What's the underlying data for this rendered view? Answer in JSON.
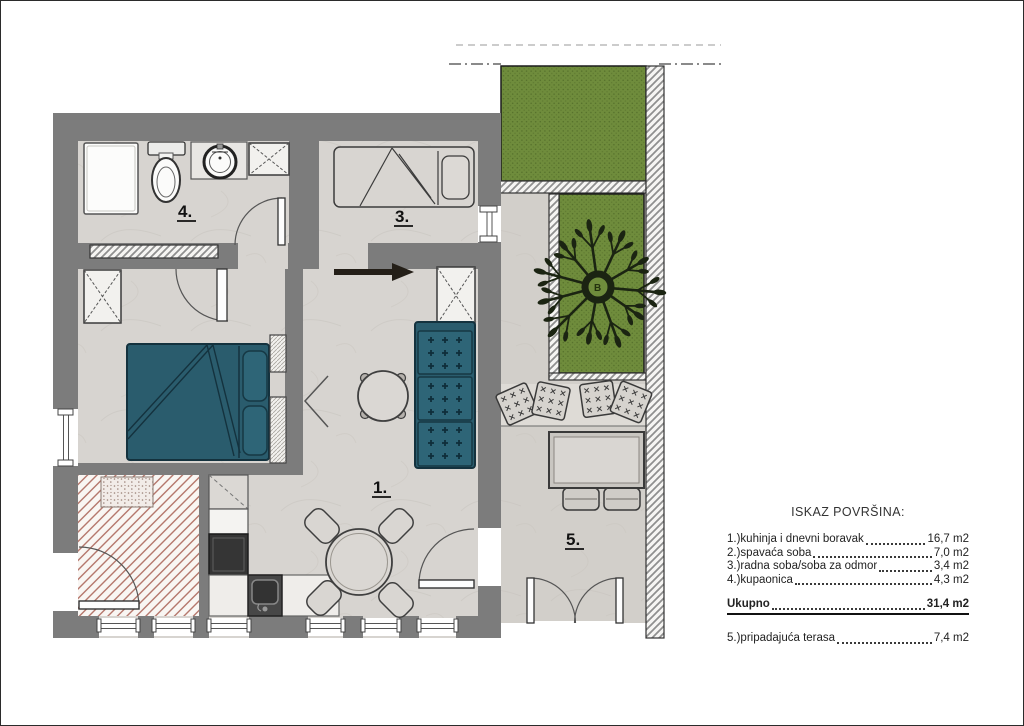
{
  "legend": {
    "title": "ISKAZ POVRŠINA:",
    "rows": [
      {
        "label": "1.)kuhinja i dnevni boravak",
        "value": "16,7 m2"
      },
      {
        "label": "2.)spavaća soba",
        "value": "7,0 m2"
      },
      {
        "label": "3.)radna soba/soba za odmor",
        "value": "3,4 m2"
      },
      {
        "label": "4.)kupaonica",
        "value": "4,3 m2"
      }
    ],
    "total": {
      "label": "Ukupno",
      "value": "31,4 m2"
    },
    "extra": {
      "label": "5.)pripadajuća terasa",
      "value": "7,4 m2"
    }
  },
  "room_labels": {
    "living": "1.",
    "work": "3.",
    "bath": "4.",
    "terrace": "5."
  },
  "tree_label": "B",
  "colors": {
    "wall": "#7c7c7c",
    "floor": "#d7d4d0",
    "terrace_floor": "#d2cfca",
    "furniture_teal": "#2a5c6d",
    "furniture_teal_light": "#2e6577",
    "garden_green": "#6f8c3c",
    "entry_hatch_red": "#b5786d",
    "appliance_dark": "#353535",
    "outline": "#2b2b2b"
  }
}
